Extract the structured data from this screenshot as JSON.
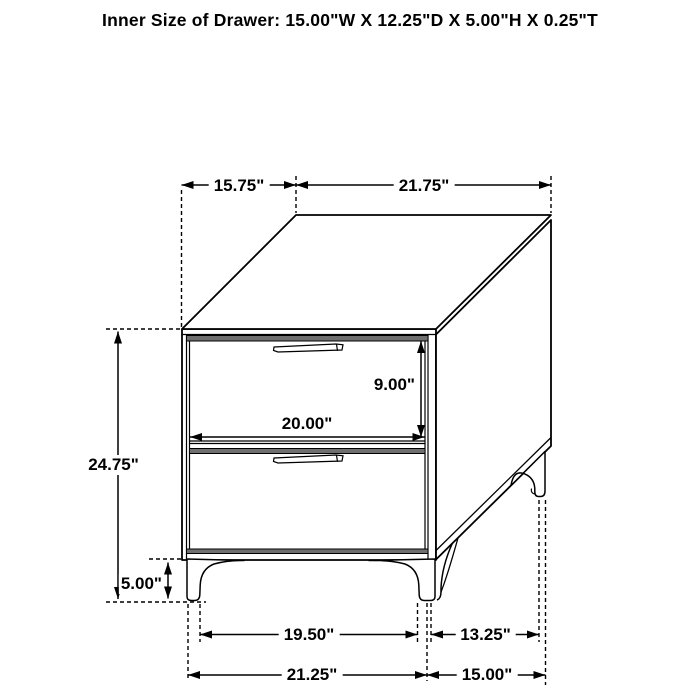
{
  "title": "Inner Size of Drawer: 15.00\"W X 12.25\"D X 5.00\"H X 0.25\"T",
  "figure": {
    "type": "furniture-dimension-diagram",
    "subject": "two-drawer nightstand, isometric line drawing",
    "colors": {
      "line": "#000000",
      "shade": "#6f6f6f",
      "background": "#ffffff"
    }
  },
  "dimensions": {
    "top_depth": "15.75\"",
    "top_width": "21.75\"",
    "overall_height": "24.75\"",
    "leg_height": "5.00\"",
    "drawer_front_height": "9.00\"",
    "drawer_front_width": "20.00\"",
    "front_feet_span": "19.50\"",
    "side_feet_gap": "13.25\"",
    "base_width": "21.25\"",
    "base_depth": "15.00\""
  }
}
